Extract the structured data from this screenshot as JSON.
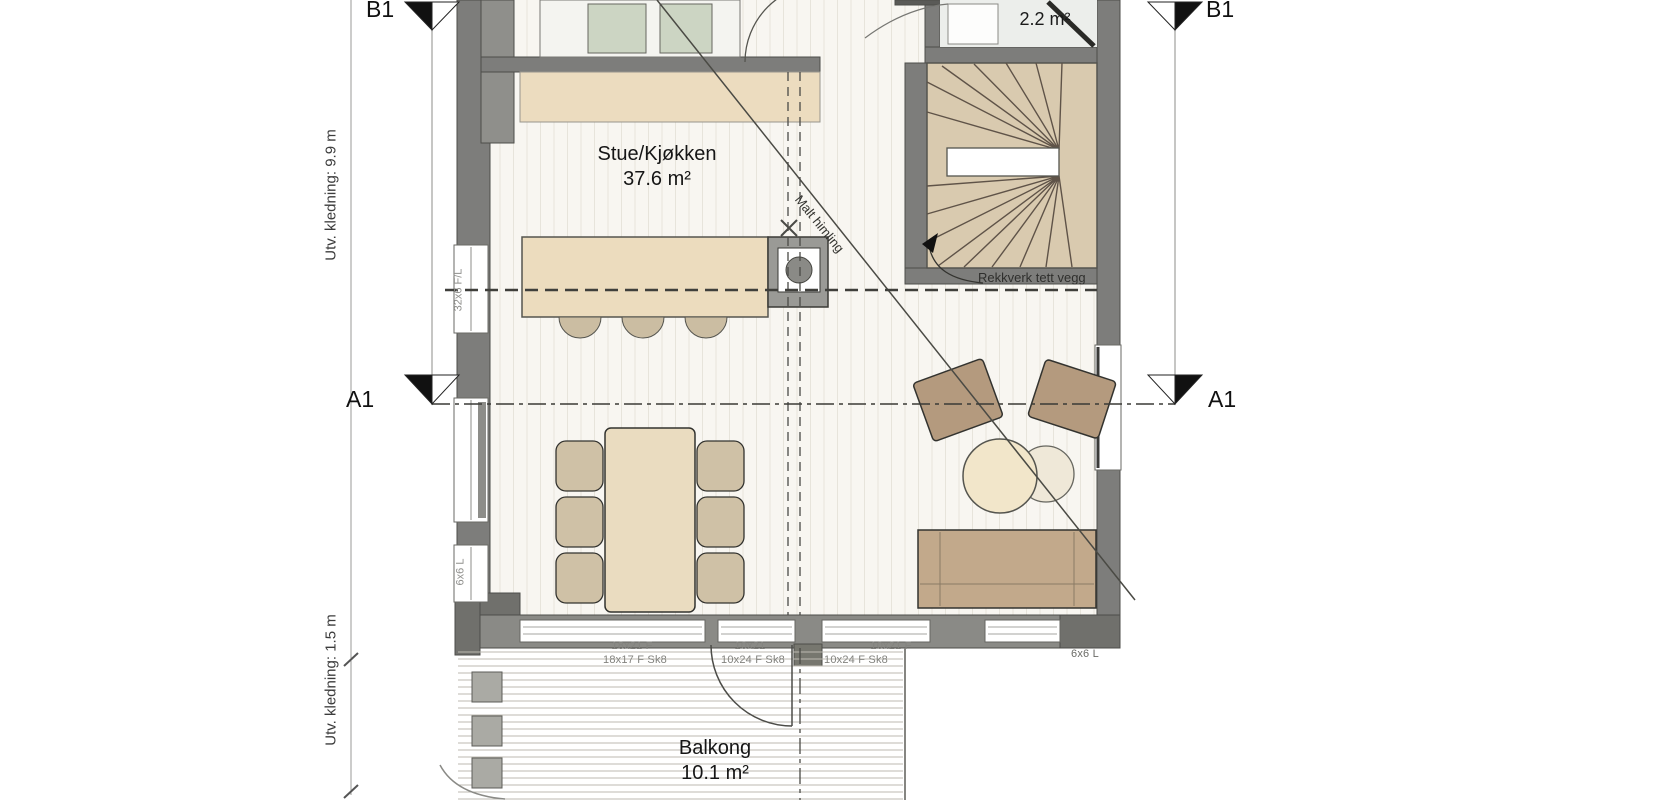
{
  "sections": {
    "a1_label": "A1",
    "b1_label": "B1"
  },
  "rooms": {
    "living": {
      "name": "Stue/Kjøkken",
      "area": "37.6 m²"
    },
    "wc": {
      "area": "2.2 m²"
    },
    "balcony": {
      "name": "Balkong",
      "area": "10.1 m²"
    }
  },
  "dimensions": {
    "cladding_upper": "Utv. kledning: 9.9 m",
    "cladding_lower": "Utv. kledning: 1.5 m"
  },
  "window_specs": {
    "left_wall_upper": "32x6 F/L",
    "left_wall_lower": "6x6 L",
    "bottom_row1": [
      "18x21 F",
      "10x21",
      "10x21 F"
    ],
    "bottom_row2": [
      "18x17 F Sk8",
      "10x24 F Sk8",
      "10x24 F Sk8"
    ],
    "bottom_right": "6x6 L"
  },
  "annotations": {
    "ceiling_note": "Malt himling",
    "stair_note": "Rekkverk tett vegg"
  },
  "colors": {
    "wall": "#7d7d7b",
    "stair_wood": "#d9caaf",
    "counter_wood": "#ecdcbf",
    "furniture_wood": "#c2a98b",
    "appliance_sage": "#ccd5c3",
    "floor": "#f8f6f1"
  }
}
